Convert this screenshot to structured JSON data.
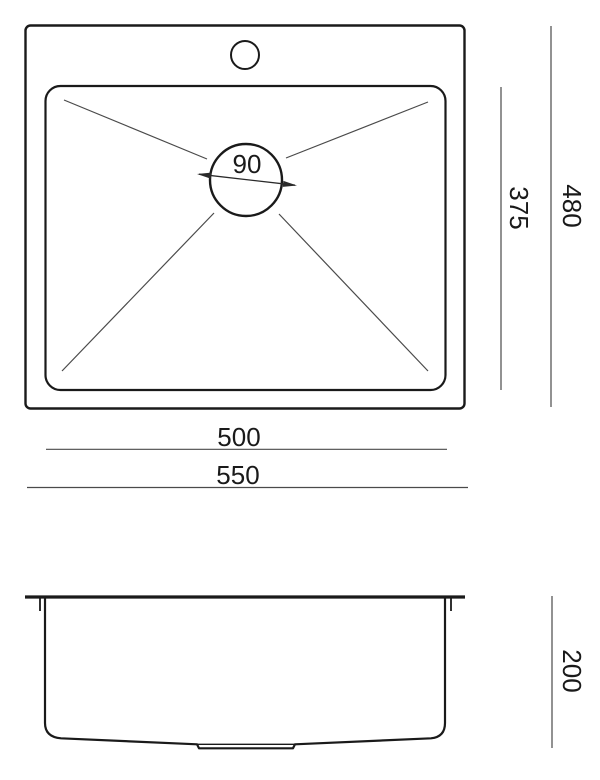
{
  "drawing": {
    "subject": "sink-dimension-diagram",
    "top_view": {
      "drain_diameter": "90",
      "bowl_length": "500",
      "overall_length": "550",
      "bowl_width": "375",
      "overall_width": "480"
    },
    "front_view": {
      "overall_height": "200"
    }
  },
  "colors": {
    "background": "#ffffff",
    "object_line": "#1a1a1a",
    "dimension_line": "#4a4a4a",
    "label_text": "#1a1a1a"
  }
}
